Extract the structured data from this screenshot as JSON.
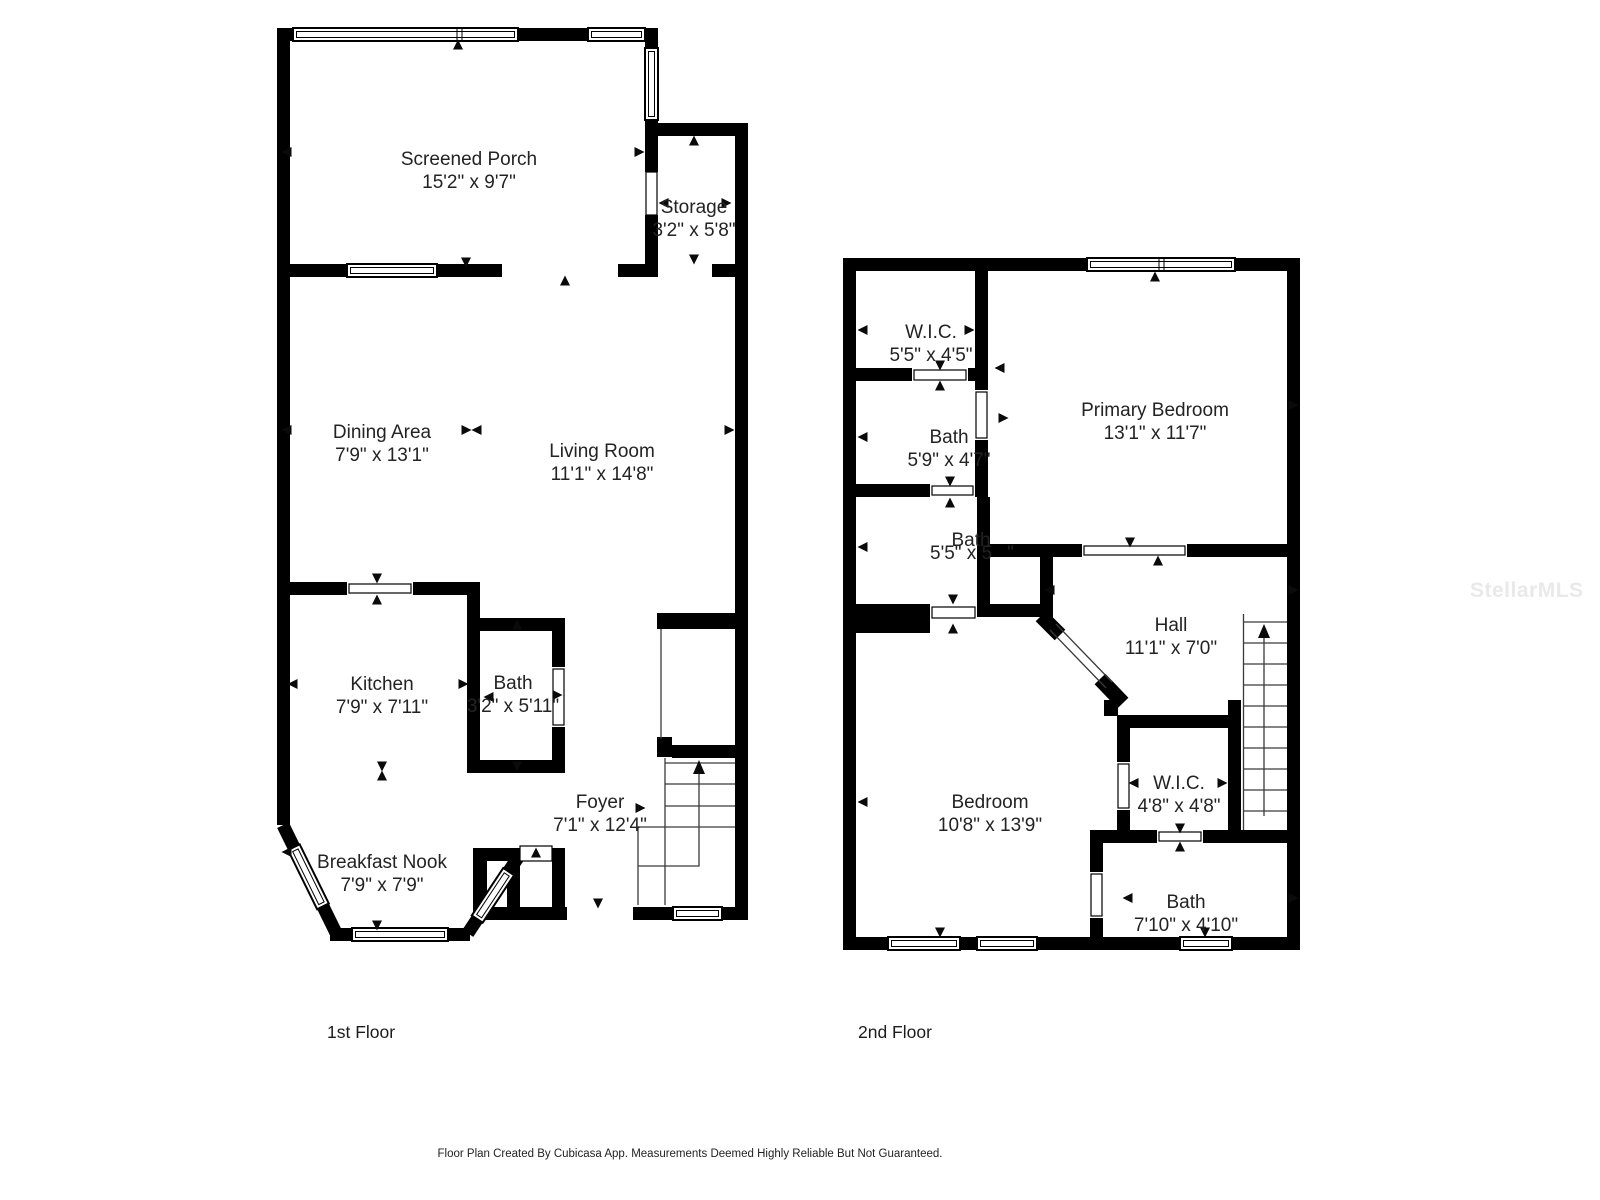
{
  "watermark": "StellarMLS",
  "caption": "Floor Plan Created By Cubicasa App. Measurements Deemed Highly Reliable But Not Guaranteed.",
  "floors": [
    {
      "label": "1st Floor",
      "rooms": [
        {
          "name": "Screened Porch",
          "dims": "15'2\" x 9'7\""
        },
        {
          "name": "Storage",
          "dims": "3'2\" x 5'8\""
        },
        {
          "name": "Dining Area",
          "dims": "7'9\" x 13'1\""
        },
        {
          "name": "Living Room",
          "dims": "11'1\" x 14'8\""
        },
        {
          "name": "Kitchen",
          "dims": "7'9\" x 7'11\""
        },
        {
          "name": "Bath",
          "dims": "3'2\" x 5'11\""
        },
        {
          "name": "Foyer",
          "dims": "7'1\" x 12'4\""
        },
        {
          "name": "Breakfast Nook",
          "dims": "7'9\" x 7'9\""
        }
      ]
    },
    {
      "label": "2nd Floor",
      "rooms": [
        {
          "name": "W.I.C.",
          "dims": "5'5\" x 4'5\""
        },
        {
          "name": "Bath",
          "dims": "5'9\" x 4'7\""
        },
        {
          "name": "Primary Bedroom",
          "dims": "13'1\" x 11'7\""
        },
        {
          "name": "Bath",
          "dims": "5'5\" x 5",
          "dims_tail": "\""
        },
        {
          "name": "Hall",
          "dims": "11'1\" x 7'0\""
        },
        {
          "name": "Bedroom",
          "dims": "10'8\" x 13'9\""
        },
        {
          "name": "W.I.C.",
          "dims": "4'8\" x 4'8\""
        },
        {
          "name": "Bath",
          "dims": "7'10\" x 4'10\""
        }
      ]
    }
  ]
}
